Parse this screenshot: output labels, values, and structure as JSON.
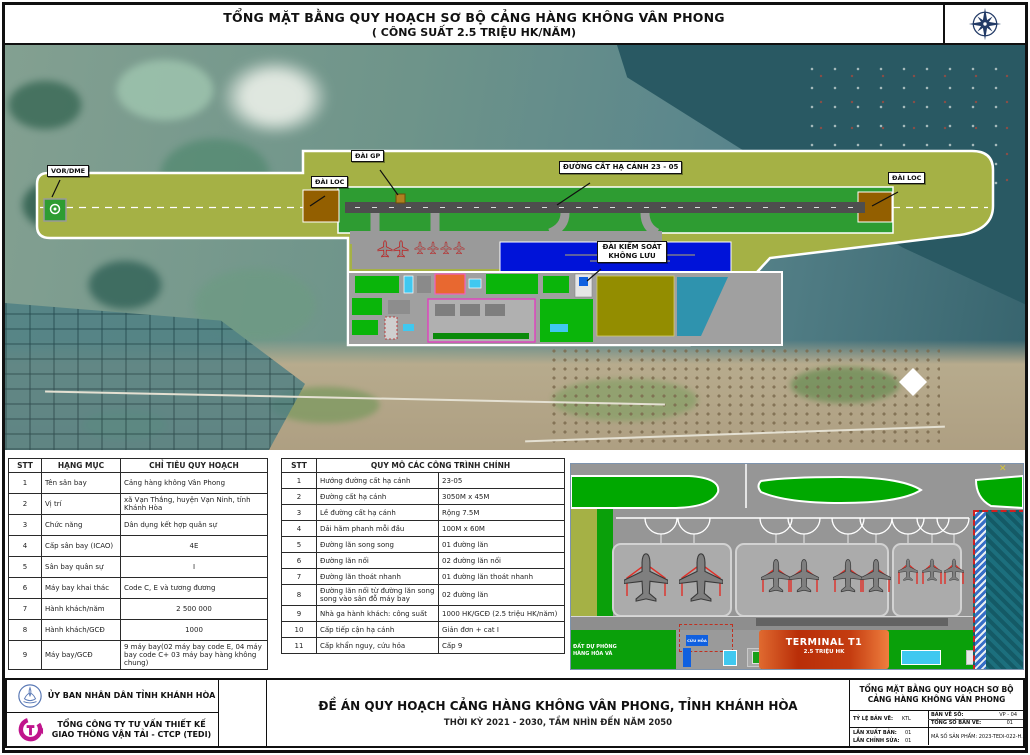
{
  "header": {
    "title_line1": "TỔNG MẶT BẰNG QUY HOẠCH SƠ BỘ CẢNG HÀNG KHÔNG VÂN PHONG",
    "title_line2": "( CÔNG SUẤT 2.5 TRIỆU HK/NĂM)"
  },
  "map": {
    "labels": {
      "vor_dme": "VOR/DME",
      "dai_gp": "ĐÀI GP",
      "dai_loc_left": "ĐÀI LOC",
      "runway": "ĐƯỜNG CẤT HẠ CÁNH  23 - 05",
      "dai_loc_right": "ĐÀI LOC",
      "tower_line1": "ĐÀI KIỂM SOÁT",
      "tower_line2": "KHÔNG LƯU"
    }
  },
  "left_table": {
    "headers": [
      "STT",
      "HẠNG MỤC",
      "CHỈ TIÊU QUY HOẠCH"
    ],
    "rows": [
      [
        "1",
        "Tên sân bay",
        "Cảng hàng không Vân Phong"
      ],
      [
        "2",
        "Vị trí",
        "xã Vạn Thắng, huyện Vạn Ninh, tỉnh Khánh Hòa"
      ],
      [
        "3",
        "Chức năng",
        "Dân dụng kết hợp quân sự"
      ],
      [
        "4",
        "Cấp sân bay (ICAO)",
        "4E"
      ],
      [
        "5",
        "Sân bay quân sự",
        "I"
      ],
      [
        "6",
        "Máy bay khai thác",
        "Code C, E và tương đương"
      ],
      [
        "7",
        "Hành khách/năm",
        "2 500 000"
      ],
      [
        "8",
        "Hành khách/GCĐ",
        "1000"
      ],
      [
        "9",
        "Máy bay/GCĐ",
        "9 máy bay(02 máy bay code E, 04 máy bay code C+ 03 máy bay hàng không chung)"
      ]
    ]
  },
  "right_table": {
    "headers": [
      "STT",
      "QUY MÔ CÁC CÔNG TRÌNH CHÍNH"
    ],
    "rows": [
      [
        "1",
        "Hướng đường cất hạ cánh",
        "23-05"
      ],
      [
        "2",
        "Đường cất hạ cánh",
        "3050M x 45M"
      ],
      [
        "3",
        "Lề đường cất hạ cánh",
        "Rộng 7.5M"
      ],
      [
        "4",
        "Dải hãm phanh mỗi đầu",
        "100M x 60M"
      ],
      [
        "5",
        "Đường lăn song song",
        "01 đường lăn"
      ],
      [
        "6",
        "Đường lăn nối",
        "02 đường lăn nối"
      ],
      [
        "7",
        "Đường lăn thoát nhanh",
        "01 đường lăn thoát nhanh"
      ],
      [
        "8",
        "Đường lăn nối từ đường lăn song song vào sân đỗ máy bay",
        "02 đường lăn"
      ],
      [
        "9",
        "Nhà ga hành khách: công suất",
        "1000 HK/GCĐ (2.5 triệu HK/năm)"
      ],
      [
        "10",
        "Cấp tiếp cận hạ cánh",
        "Giản đơn + cat I"
      ],
      [
        "11",
        "Cấp khẩn nguy, cứu hỏa",
        "Cấp 9"
      ]
    ]
  },
  "detail": {
    "labels": {
      "terminal": "TERMINAL T1",
      "terminal_capacity": "2.5 TRIỆU HK",
      "fire": "CỨU HỎA",
      "vip": "VIP",
      "reserve_line1": "ĐẤT DỰ PHÒNG",
      "reserve_line2": "HÀNG HÓA VÀ"
    }
  },
  "footer": {
    "org1": "ỦY BAN NHÂN DÂN TỈNH KHÁNH HÒA",
    "org2_line1": "TỔNG CÔNG TY TƯ VẤN THIẾT KẾ",
    "org2_line2": "GIAO THÔNG VẬN TẢI - CTCP (TEDI)",
    "project_title": "ĐỀ ÁN QUY HOẠCH CẢNG HÀNG KHÔNG VÂN PHONG, TỈNH KHÁNH HÒA",
    "project_period": "THỜI KỲ 2021 - 2030, TẦM NHÌN ĐẾN NĂM 2050",
    "sheet_title_line1": "TỔNG MẶT BẰNG QUY HOẠCH SƠ BỘ",
    "sheet_title_line2": "CẢNG HÀNG KHÔNG VÂN PHONG",
    "scale_label": "TỶ LỆ BẢN VẼ:",
    "scale_value": "KTL",
    "drawing_no_label": "BẢN VẼ SỐ:",
    "drawing_no_value": "VP - 04",
    "total_sheets_label": "TỔNG SỐ BẢN VẼ:",
    "total_sheets_value": "01",
    "edition_label": "LẦN XUẤT BẢN:",
    "edition_value": "01",
    "revision_label": "LẦN CHỈNH SỬA:",
    "revision_value": "01",
    "product_code": "MÃ SỐ SẢN PHẨM: 2023-TEDI-022-H.K"
  },
  "colors": {
    "airfield_olive": "#a5b145",
    "runway_strip_green": "#2e9c32",
    "reserve_blue": "#0013d9",
    "landside_green": "#0ab50a",
    "terminal_orange": "#c4420e",
    "sea_teal": "#295963",
    "loc_brown": "#935f00",
    "teal_zone": "#1c6f7d"
  }
}
